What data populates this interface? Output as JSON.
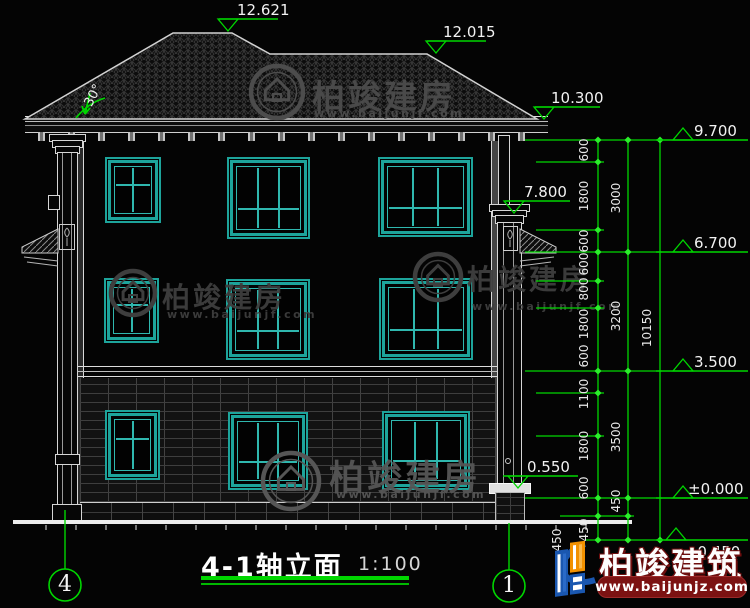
{
  "title_block": {
    "title": "4-1轴立面",
    "scale": "1:100"
  },
  "annotations": {
    "roof_angle": "30°"
  },
  "watermark": {
    "name": "柏竣建房",
    "url": "www.baijunjf.com"
  },
  "brand": {
    "name": "柏竣建筑",
    "url": "www.baijunjz.com"
  },
  "colors": {
    "green": "#00d600",
    "tick_green": "#2bee2b",
    "teal": "#1da49b",
    "white": "#e8e8e8"
  },
  "grid_bubbles": [
    {
      "label": "4",
      "cx": 65,
      "cy": 585,
      "r": 16,
      "line_y1": 510,
      "line_y2": 569
    },
    {
      "label": "1",
      "cx": 509,
      "cy": 586,
      "r": 16,
      "line_y1": 523,
      "line_y2": 570
    }
  ],
  "elevation_marks": [
    {
      "value": "12.621",
      "x1": 219,
      "x2": 278,
      "y": 19,
      "apex": 228,
      "tri": "below",
      "text": "above",
      "tx": 237
    },
    {
      "value": "12.015",
      "x1": 427,
      "x2": 486,
      "y": 41,
      "apex": 436,
      "tri": "below",
      "text": "above",
      "tx": 443
    },
    {
      "value": "10.300",
      "x1": 535,
      "x2": 600,
      "y": 107,
      "apex": 544,
      "tri": "below",
      "text": "above",
      "tx": 551
    },
    {
      "value": "7.800",
      "x1": 505,
      "x2": 570,
      "y": 201,
      "apex": 514,
      "tri": "below",
      "text": "above",
      "tx": 524
    },
    {
      "value": "0.550",
      "x1": 503,
      "x2": 578,
      "y": 476,
      "apex": 518,
      "tri": "below",
      "text": "above",
      "tx": 527
    },
    {
      "value": "9.700",
      "x1": 656,
      "x2": 748,
      "y": 140,
      "apex": 683,
      "tri": "above",
      "text": "above",
      "tx": 694
    },
    {
      "value": "6.700",
      "x1": 656,
      "x2": 748,
      "y": 252,
      "apex": 683,
      "tri": "above",
      "text": "above",
      "tx": 694
    },
    {
      "value": "3.500",
      "x1": 656,
      "x2": 748,
      "y": 371,
      "apex": 683,
      "tri": "above",
      "text": "above",
      "tx": 694
    },
    {
      "value": "±0.000",
      "x1": 656,
      "x2": 748,
      "y": 498,
      "apex": 683,
      "tri": "above",
      "text": "above",
      "tx": 688
    },
    {
      "value": "-0.450",
      "x1": 656,
      "x2": 748,
      "y": 540,
      "apex": 676,
      "tri": "above",
      "text": "below",
      "tx": 692
    }
  ],
  "dimension_labels": [
    {
      "text": "600",
      "x": 584,
      "y": 150
    },
    {
      "text": "1800",
      "x": 584,
      "y": 196
    },
    {
      "text": "600",
      "x": 584,
      "y": 241
    },
    {
      "text": "600",
      "x": 584,
      "y": 264
    },
    {
      "text": "800",
      "x": 584,
      "y": 289
    },
    {
      "text": "1800",
      "x": 584,
      "y": 324
    },
    {
      "text": "600",
      "x": 584,
      "y": 356
    },
    {
      "text": "1100",
      "x": 584,
      "y": 394
    },
    {
      "text": "1800",
      "x": 584,
      "y": 446
    },
    {
      "text": "600",
      "x": 584,
      "y": 488
    },
    {
      "text": "450",
      "x": 584,
      "y": 530
    },
    {
      "text": "3000",
      "x": 616,
      "y": 198
    },
    {
      "text": "3200",
      "x": 616,
      "y": 316
    },
    {
      "text": "3500",
      "x": 616,
      "y": 437
    },
    {
      "text": "450",
      "x": 616,
      "y": 501
    },
    {
      "text": "10150",
      "x": 647,
      "y": 328
    },
    {
      "text": "450",
      "x": 557,
      "y": 540
    }
  ],
  "dimension_vlines": [
    {
      "x": 598,
      "y1": 140,
      "y2": 540
    },
    {
      "x": 628,
      "y1": 140,
      "y2": 540
    },
    {
      "x": 660,
      "y1": 140,
      "y2": 540
    }
  ],
  "dimension_hlines": [
    {
      "y": 140,
      "x1": 525,
      "x2": 662
    },
    {
      "y": 252,
      "x1": 525,
      "x2": 662
    },
    {
      "y": 371,
      "x1": 525,
      "x2": 662
    },
    {
      "y": 498,
      "x1": 525,
      "x2": 662
    },
    {
      "y": 162,
      "x1": 536,
      "x2": 604
    },
    {
      "y": 230,
      "x1": 536,
      "x2": 604
    },
    {
      "y": 281,
      "x1": 536,
      "x2": 604
    },
    {
      "y": 308,
      "x1": 536,
      "x2": 604
    },
    {
      "y": 393,
      "x1": 536,
      "x2": 604
    },
    {
      "y": 436,
      "x1": 536,
      "x2": 604
    },
    {
      "y": 516,
      "x1": 560,
      "x2": 634
    },
    {
      "y": 540,
      "x1": 585,
      "x2": 662
    }
  ],
  "dimension_ticks": [
    {
      "x": 598,
      "ys": [
        140,
        162,
        230,
        252,
        281,
        308,
        371,
        393,
        436,
        498,
        516,
        540
      ]
    },
    {
      "x": 628,
      "ys": [
        140,
        252,
        371,
        498,
        516,
        540
      ]
    },
    {
      "x": 660,
      "ys": [
        140,
        540
      ]
    }
  ],
  "windows": [
    {
      "x": 105,
      "y": 157,
      "w": 56,
      "h": 66,
      "type": "small"
    },
    {
      "x": 227,
      "y": 157,
      "w": 83,
      "h": 82,
      "type": "large"
    },
    {
      "x": 378,
      "y": 157,
      "w": 95,
      "h": 80,
      "type": "large"
    },
    {
      "x": 104,
      "y": 278,
      "w": 55,
      "h": 65,
      "type": "small"
    },
    {
      "x": 226,
      "y": 279,
      "w": 84,
      "h": 81,
      "type": "large"
    },
    {
      "x": 379,
      "y": 278,
      "w": 94,
      "h": 82,
      "type": "large"
    },
    {
      "x": 105,
      "y": 410,
      "w": 55,
      "h": 70,
      "type": "small"
    },
    {
      "x": 228,
      "y": 412,
      "w": 80,
      "h": 78,
      "type": "large"
    },
    {
      "x": 382,
      "y": 411,
      "w": 88,
      "h": 79,
      "type": "large"
    }
  ],
  "window_styles": {
    "small": {
      "v": [
        0.5
      ],
      "rail": 0.38
    },
    "large": {
      "v": [
        0.333,
        0.667
      ],
      "rail": 0.69
    }
  },
  "watermark_instances": [
    {
      "cx": 277,
      "cy": 92,
      "r": 26,
      "tx": 312,
      "ty": 70,
      "fs": 33,
      "ux": 314,
      "uy": 107,
      "color": "#4c4c4c"
    },
    {
      "cx": 133,
      "cy": 293,
      "r": 22,
      "tx": 162,
      "ty": 276,
      "fs": 28,
      "ux": 167,
      "uy": 308,
      "color": "#3e3e3e"
    },
    {
      "cx": 438,
      "cy": 277,
      "r": 23,
      "tx": 467,
      "ty": 258,
      "fs": 28,
      "ux": 472,
      "uy": 300,
      "color": "#3e3e3e"
    },
    {
      "cx": 291,
      "cy": 481,
      "r": 28,
      "tx": 329,
      "ty": 450,
      "fs": 35,
      "ux": 336,
      "uy": 488,
      "color": "#565656"
    }
  ]
}
